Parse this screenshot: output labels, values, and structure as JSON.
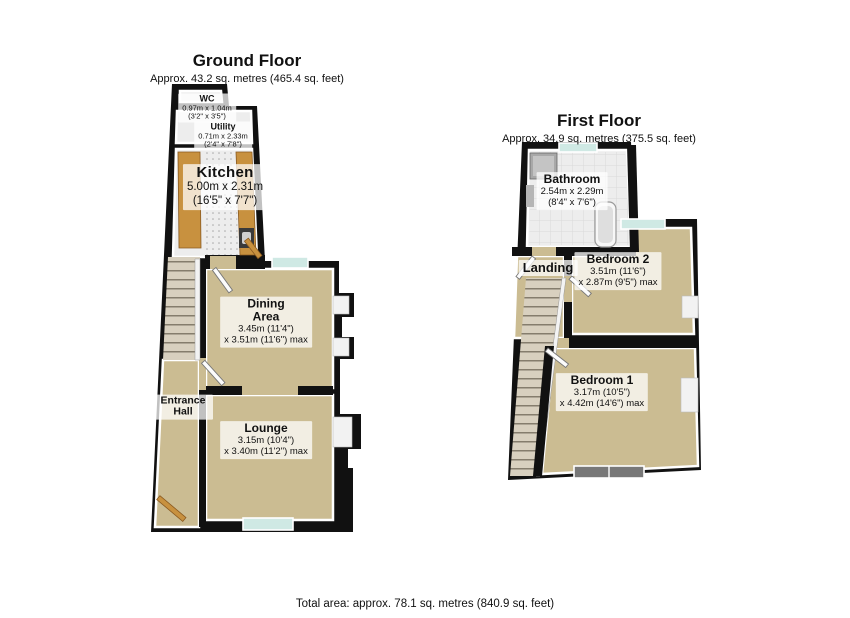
{
  "footer": {
    "total_area": "Total area: approx. 78.1 sq. metres (840.9 sq. feet)"
  },
  "ground_floor": {
    "title": "Ground Floor",
    "subtitle": "Approx. 43.2 sq. metres (465.4 sq. feet)",
    "rooms": {
      "wc": {
        "name": "WC",
        "line1": "0.97m x 1.04m",
        "line2": "(3'2\" x 3'5\")"
      },
      "utility": {
        "name": "Utility",
        "line1": "0.71m x 2.33m",
        "line2": "(2'4\" x 7'8\")"
      },
      "kitchen": {
        "name": "Kitchen",
        "line1": "5.00m x 2.31m",
        "line2": "(16'5\" x 7'7\")"
      },
      "dining": {
        "name": "Dining Area",
        "line1": "3.45m (11'4\")",
        "line2": "x 3.51m (11'6\") max"
      },
      "lounge": {
        "name": "Lounge",
        "line1": "3.15m (10'4\")",
        "line2": "x 3.40m (11'2\") max"
      },
      "entrance_hall": {
        "name": "Entrance Hall"
      }
    }
  },
  "first_floor": {
    "title": "First Floor",
    "subtitle": "Approx. 34.9 sq. metres (375.5 sq. feet)",
    "rooms": {
      "bathroom": {
        "name": "Bathroom",
        "line1": "2.54m x 2.29m",
        "line2": "(8'4\" x 7'6\")"
      },
      "landing": {
        "name": "Landing"
      },
      "bedroom2": {
        "name": "Bedroom 2",
        "line1": "3.51m (11'6\")",
        "line2": "x 2.87m (9'5\") max"
      },
      "bedroom1": {
        "name": "Bedroom 1",
        "line1": "3.17m (10'5\")",
        "line2": "x 4.42m (14'6\") max"
      }
    }
  },
  "colors": {
    "wall": "#111111",
    "carpet": "#cbbc92",
    "hard_floor": "#ededed",
    "window_glass": "#cfe9e4",
    "wood": "#c8913f",
    "stair": "#d8d0bf",
    "fixture": "#9a9a9a"
  }
}
